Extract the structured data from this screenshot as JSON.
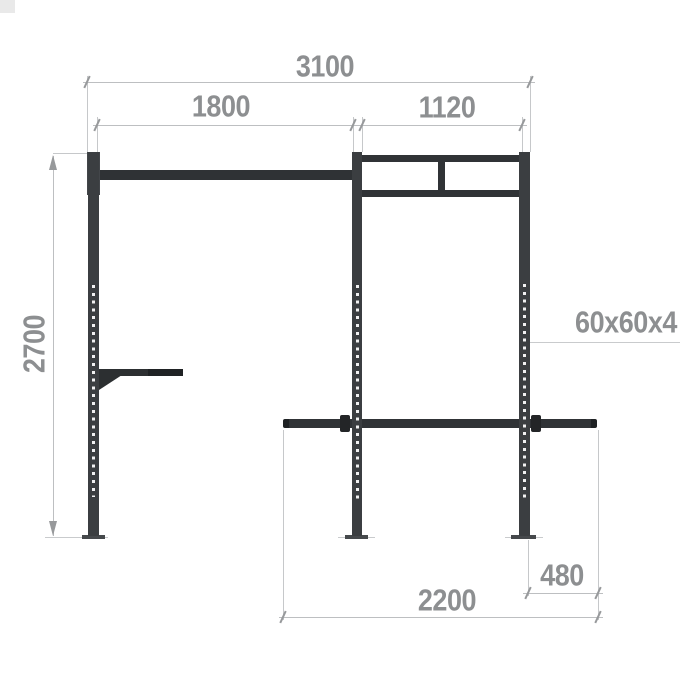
{
  "diagram": {
    "type": "technical drawing - wall gym rig side elevation",
    "dimension_labels": {
      "overall_width": "3100",
      "pullup_span": "1800",
      "frame_span": "1120",
      "overall_height": "2700",
      "tube_profile": "60x60x4",
      "overhang": "480",
      "lower_bar_length": "2200"
    },
    "colors": {
      "structure": "#3b3e41",
      "structure_dark": "#2c2f31",
      "dimension_line": "#bdbfc1",
      "extension_line": "#c6c8ca",
      "tick": "#97999b",
      "label_text": "#8d8f91",
      "background": "#ffffff"
    }
  }
}
